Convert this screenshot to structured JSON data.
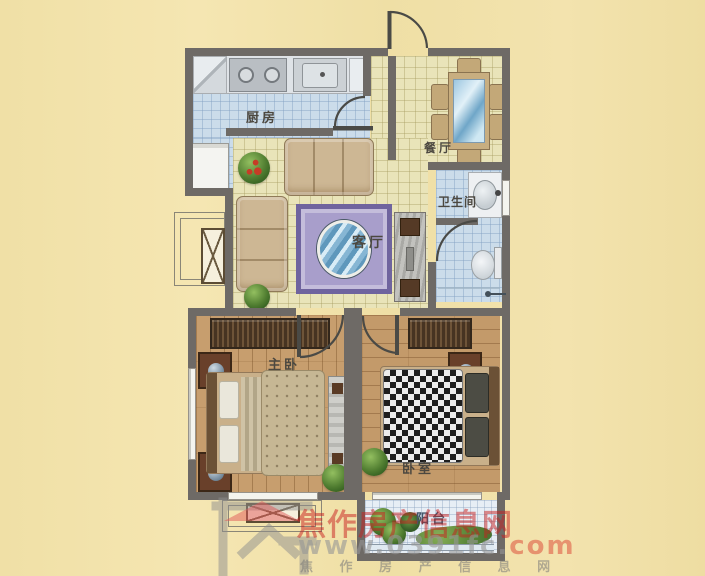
{
  "rooms": {
    "kitchen": "厨房",
    "dining": "餐厅",
    "living": "客厅",
    "bathroom": "卫生间",
    "master_bedroom": "主卧",
    "bedroom": "卧室",
    "balcony": "阳台"
  },
  "watermark": {
    "site_name": "焦作房产信息网",
    "url_gray": "www.0391fc.",
    "url_red": "com",
    "tagline": "焦 作 房 产 信 息 网"
  },
  "colors": {
    "wall": "#6e6a66",
    "background": "#f2e2ab",
    "kitchen_tile": "#cbdcea",
    "living_tile": "#e9e4b9",
    "wood_floor": "#c79e6e",
    "balcony_tile": "#e7eef5",
    "watermark_red": "#c82323"
  }
}
